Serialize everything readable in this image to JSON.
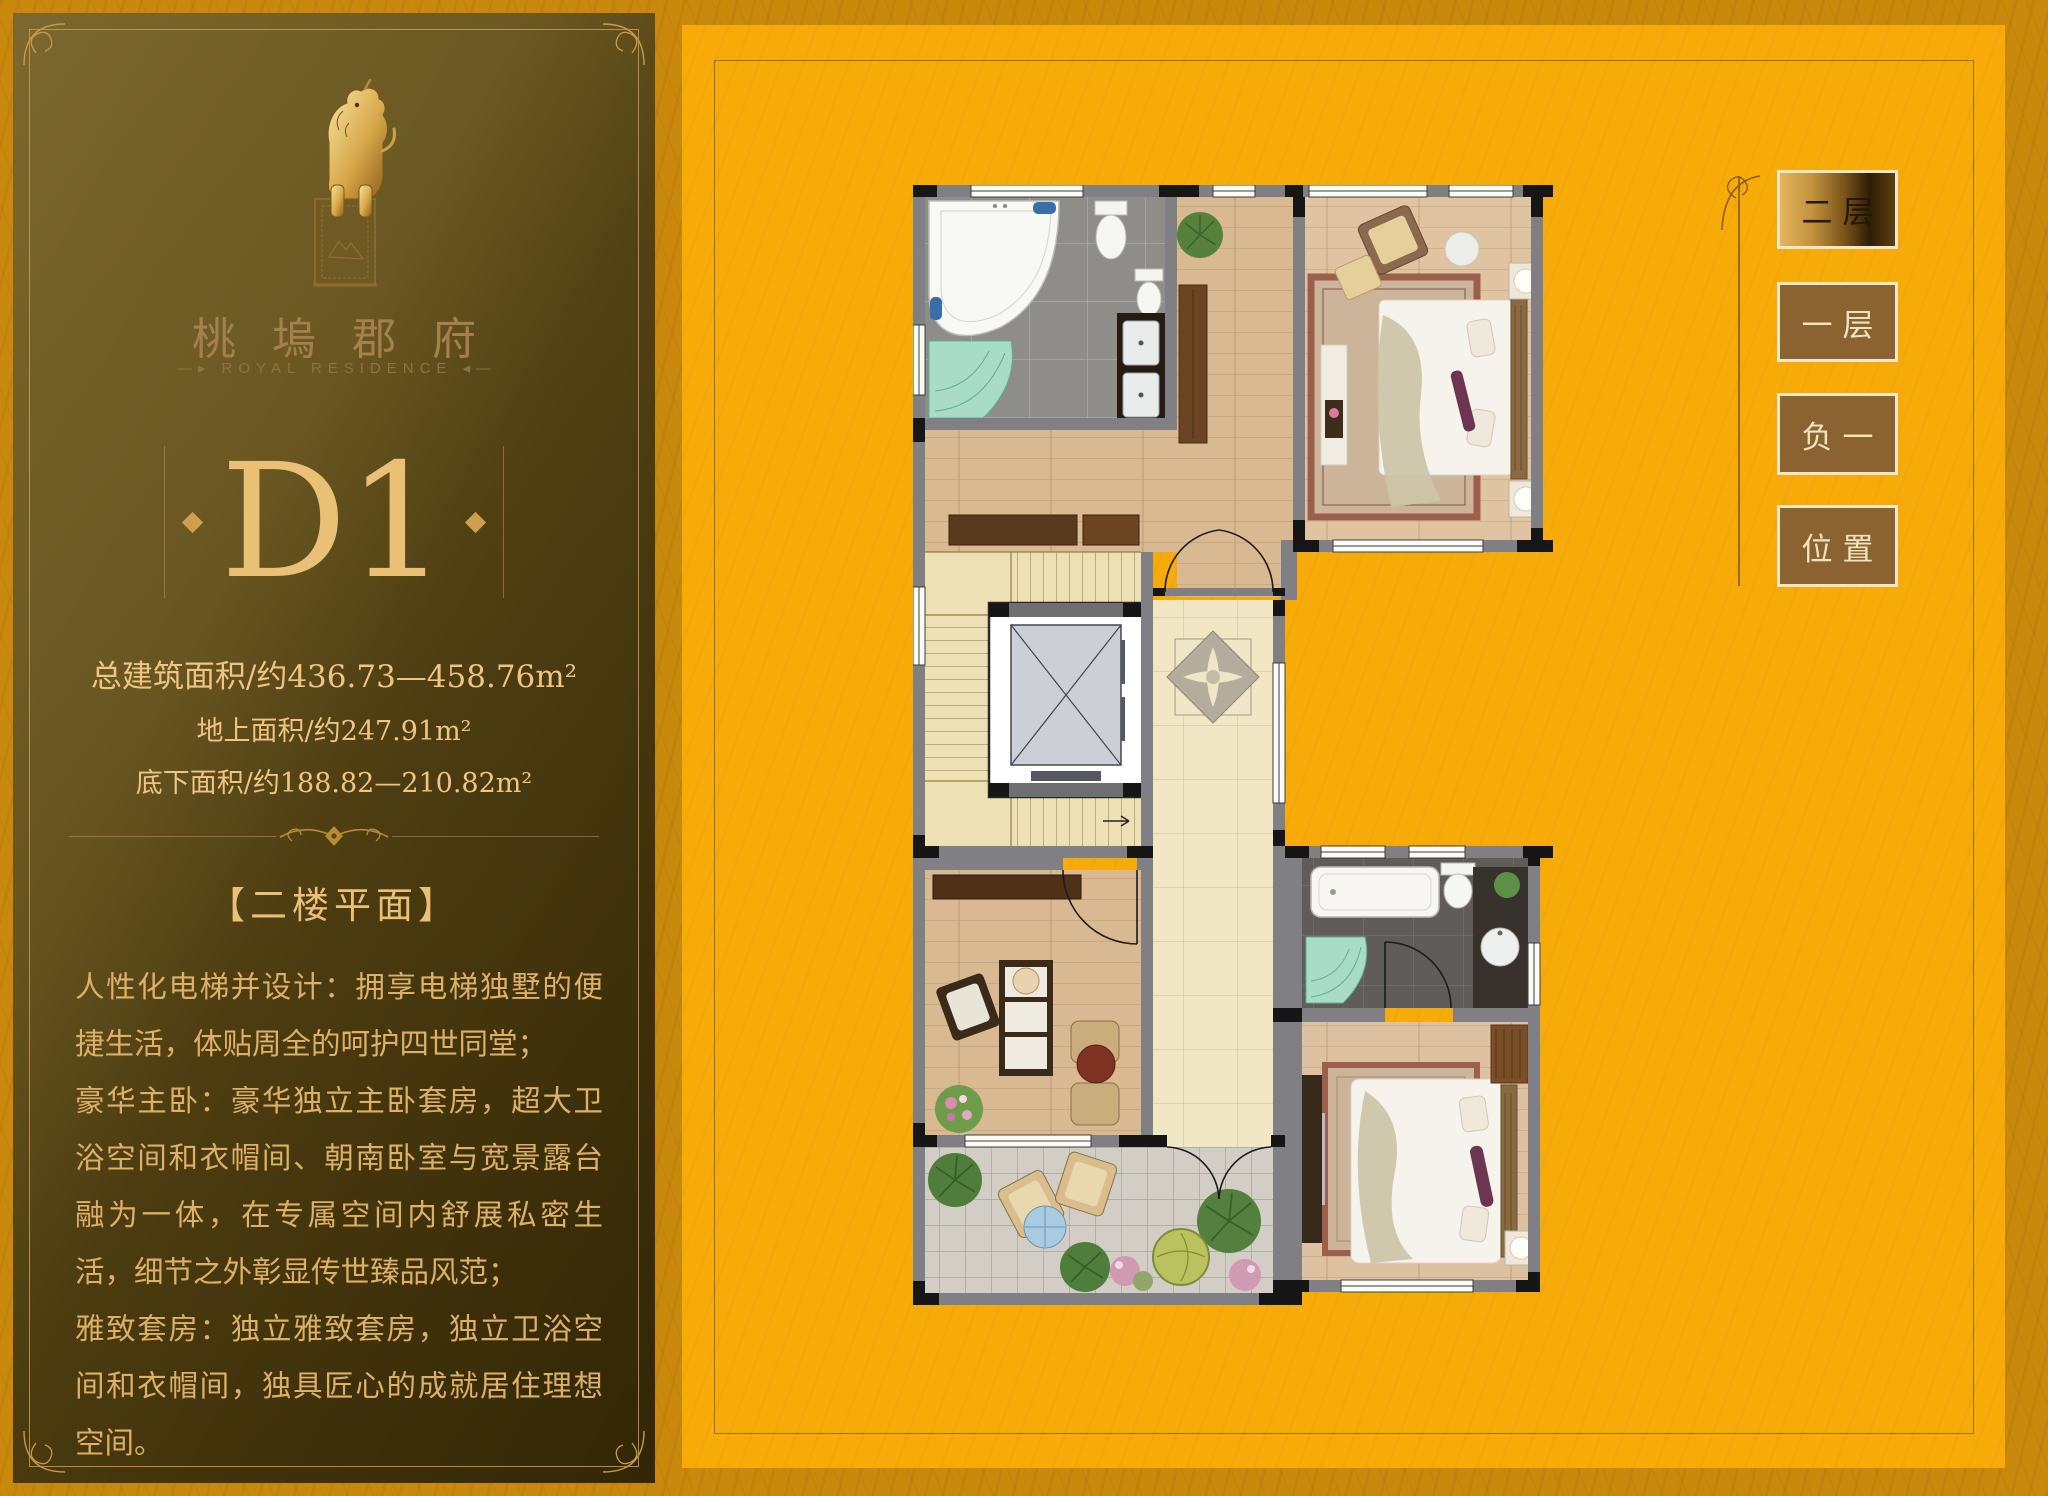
{
  "brand": {
    "logo_icon": "qilin-statue-icon",
    "name": "桃塢郡府",
    "tagline": "—▸ ROYAL RESIDENCE ◂—"
  },
  "unit": {
    "label": "D1"
  },
  "areas": {
    "total": "总建筑面积/约436.73—458.76m²",
    "above": "地上面积/约247.91m²",
    "below": "底下面积/约188.82—210.82m²"
  },
  "section": {
    "heading": "【二楼平面】",
    "paragraphs": [
      "人性化电梯并设计：拥享电梯独墅的便捷生活，体贴周全的呵护四世同堂；",
      "豪华主卧：豪华独立主卧套房，超大卫浴空间和衣帽间、朝南卧室与宽景露台融为一体，在专属空间内舒展私密生活，细节之外彰显传世臻品风范；",
      "雅致套房：独立雅致套房，独立卫浴空间和衣帽间，独具匠心的成就居住理想空间。"
    ]
  },
  "floor_nav": {
    "items": [
      {
        "label": "二层",
        "selected": true
      },
      {
        "label": "一层",
        "selected": false
      },
      {
        "label": "负一",
        "selected": false
      },
      {
        "label": "位置",
        "selected": false
      }
    ]
  },
  "colors": {
    "page_background": "#c8870b",
    "canvas_yellow": "#f7ab09",
    "frame_line": "#a26d07",
    "panel_brown": "#5a4714",
    "gold_text": "#eabf76",
    "brand_tan": "#a4804a",
    "button_brown": "#8a6331",
    "button_border": "#f3e7c9",
    "button_selected_text": "#241703"
  }
}
